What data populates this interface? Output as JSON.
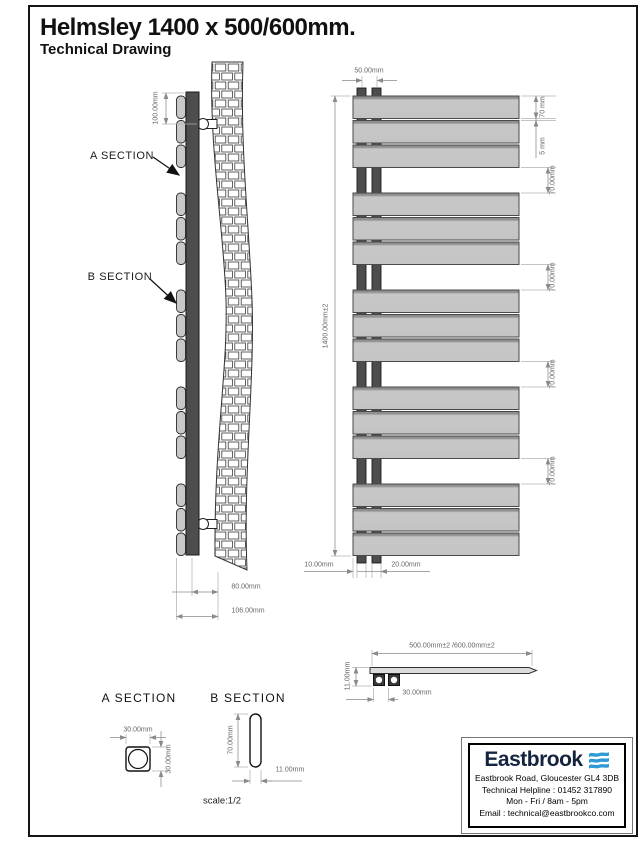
{
  "page": {
    "title": "Helmsley 1400 x 500/600mm.",
    "subtitle": "Technical Drawing"
  },
  "side_view": {
    "a_section_label": "A SECTION",
    "b_section_label": "B SECTION",
    "dim_bracket_offset": "100.00mm",
    "dim_depth_inner": "80.00mm",
    "dim_depth_total": "106.00mm"
  },
  "front_view": {
    "dim_tube_spacing": "50.00mm",
    "dim_panel_height": "70 mm",
    "dim_panel_gap": "5 mm",
    "dim_group_gaps": [
      "70.00mm",
      "70.00mm",
      "70.00mm",
      "70.00mm"
    ],
    "dim_overall_height": "1400.00mm±2",
    "dim_left_offset": "10.00mm",
    "dim_tube_gap": "20.00mm"
  },
  "top_view": {
    "dim_overall_width": "500.00mm±2 /600.00mm±2",
    "dim_panel_thickness": "11.00mm",
    "dim_tube_spacing": "30.00mm"
  },
  "section_a": {
    "title": "A SECTION",
    "dim_width": "30.00mm",
    "dim_height": "30.00mm"
  },
  "section_b": {
    "title": "B SECTION",
    "dim_height": "70.00mm",
    "dim_width": "11.00mm"
  },
  "scale_note": "scale:1/2",
  "brand": {
    "name": "Eastbrook",
    "address": "Eastbrook Road, Gloucester GL4 3DB",
    "helpline": "Technical Helpline : 01452 317890",
    "hours": "Mon - Fri / 8am - 5pm",
    "email": "Email : technical@eastbrookco.com"
  },
  "colors": {
    "accent": "#2e9bd6",
    "navy": "#15233f",
    "panel": "#c8c8c8",
    "tube": "#4d4d4d"
  }
}
